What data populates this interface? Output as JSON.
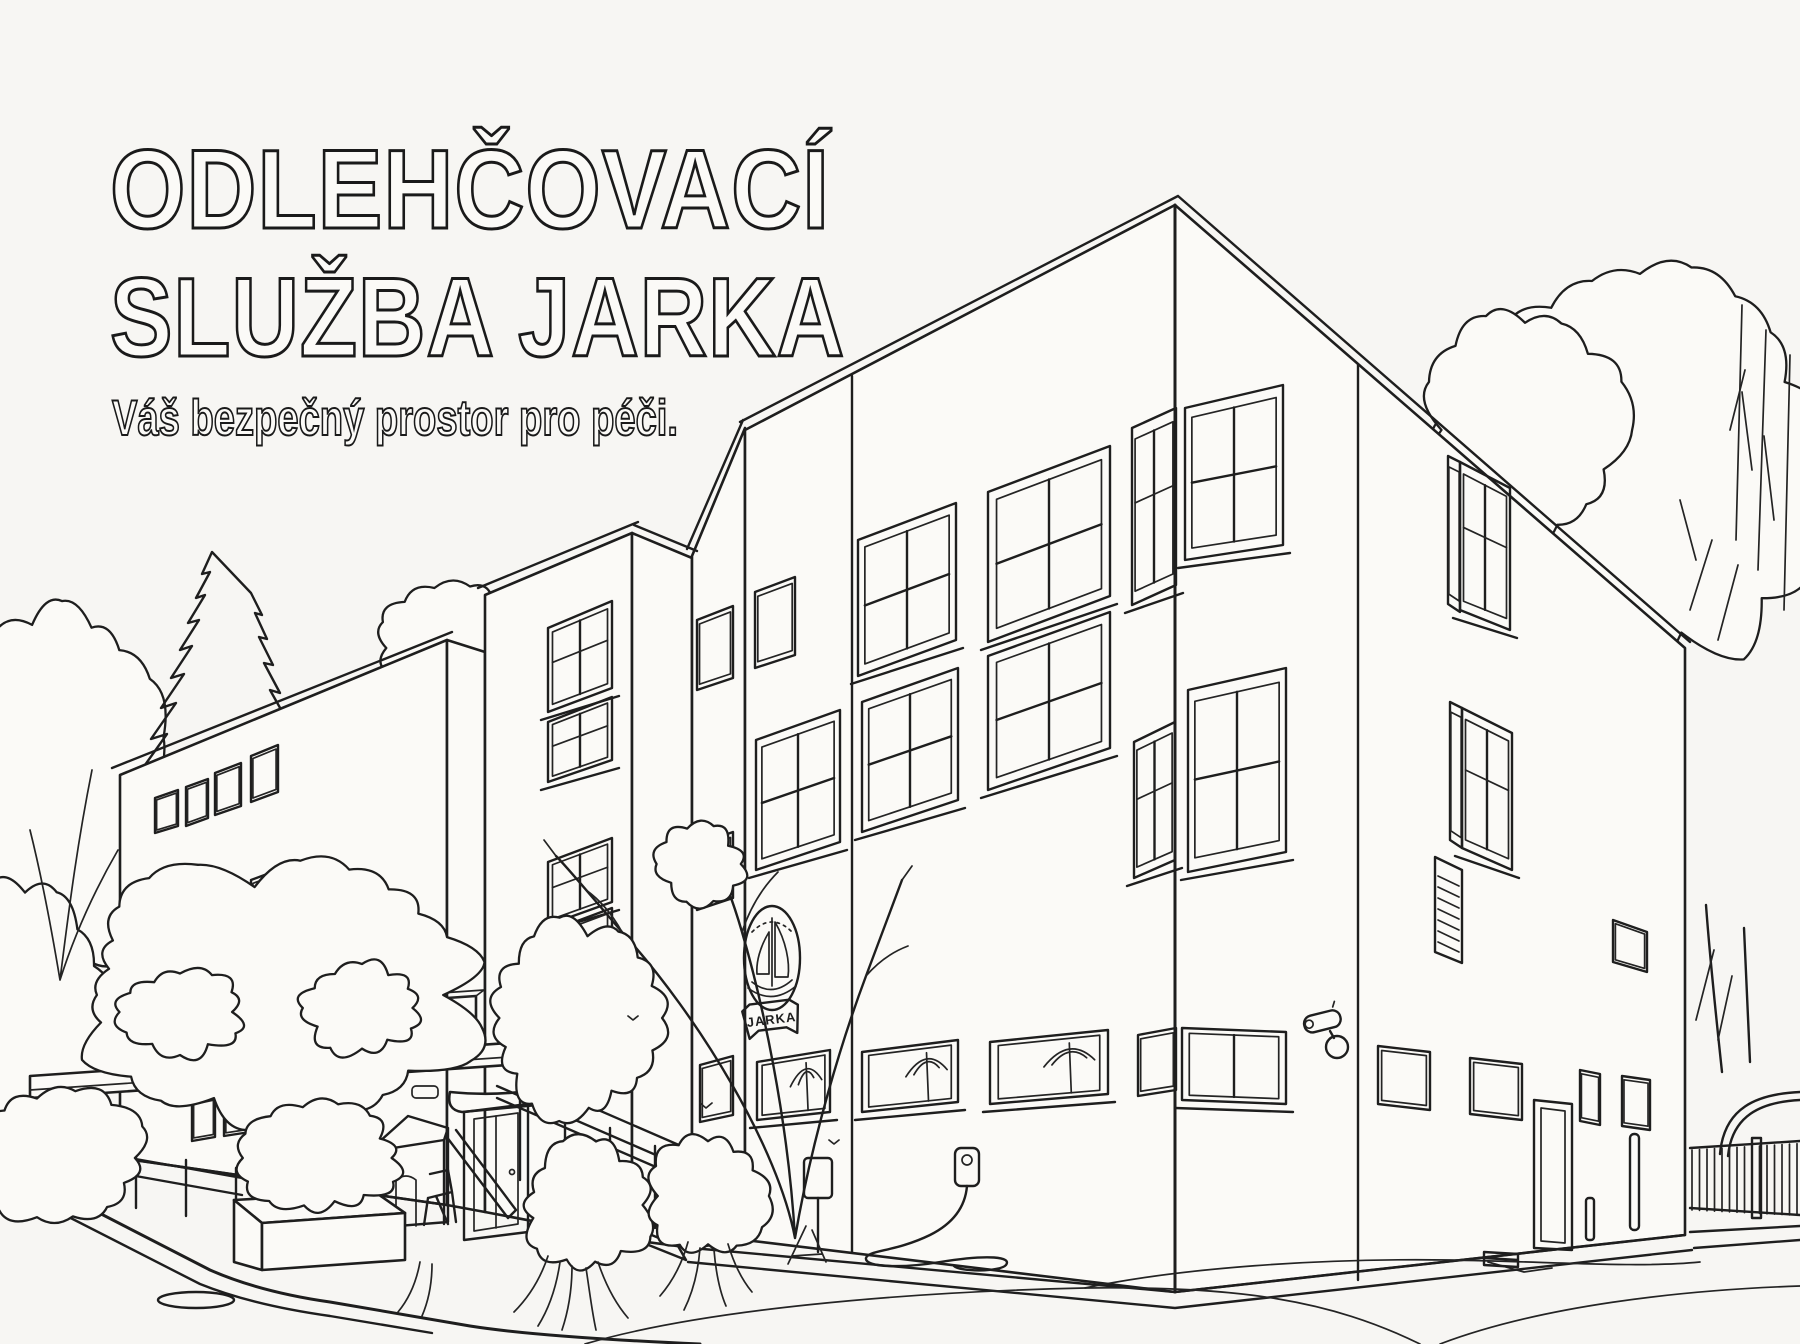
{
  "palette": {
    "background": "#f7f6f3",
    "ink": "#1e1e1e",
    "paper_fill": "#fbfaf7"
  },
  "header": {
    "title_line1": "ODLEHČOVACÍ",
    "title_line2": "SLUŽBA JARKA",
    "subtitle": "Váš bezpečný prostor pro péči."
  },
  "building_logo": {
    "text": "JARKA",
    "symbol": "sailboat-in-oval-badge"
  },
  "scene": {
    "style": "black outline coloring-book illustration, no fill colors",
    "elements": [
      "three-story care-facility building in two-point perspective",
      "left-wing with small square windows",
      "stairwell-tower with stacked windows",
      "main-facade with large four-pane windows",
      "sailboat JARKA logo badge on facade",
      "ground-floor strip windows with awnings",
      "right-facade with tall windows and louvered vent",
      "security-camera on facade",
      "entrance-canopy with two AC units",
      "entrance-door with eyebrow canopy",
      "outdoor-stairs with railing",
      "small play-house and chair under canopy",
      "access-ramp railing",
      "concrete planter box with shrub",
      "scribbled bushes and grasses",
      "bare twiggy tree in front of facade",
      "conifer and deciduous trees on the left",
      "large leafy trees on the right",
      "picket fence with arched shelter",
      "sign-post and wall charger with looped cable",
      "paved forecourt with curb, manhole cover and cracks"
    ]
  }
}
